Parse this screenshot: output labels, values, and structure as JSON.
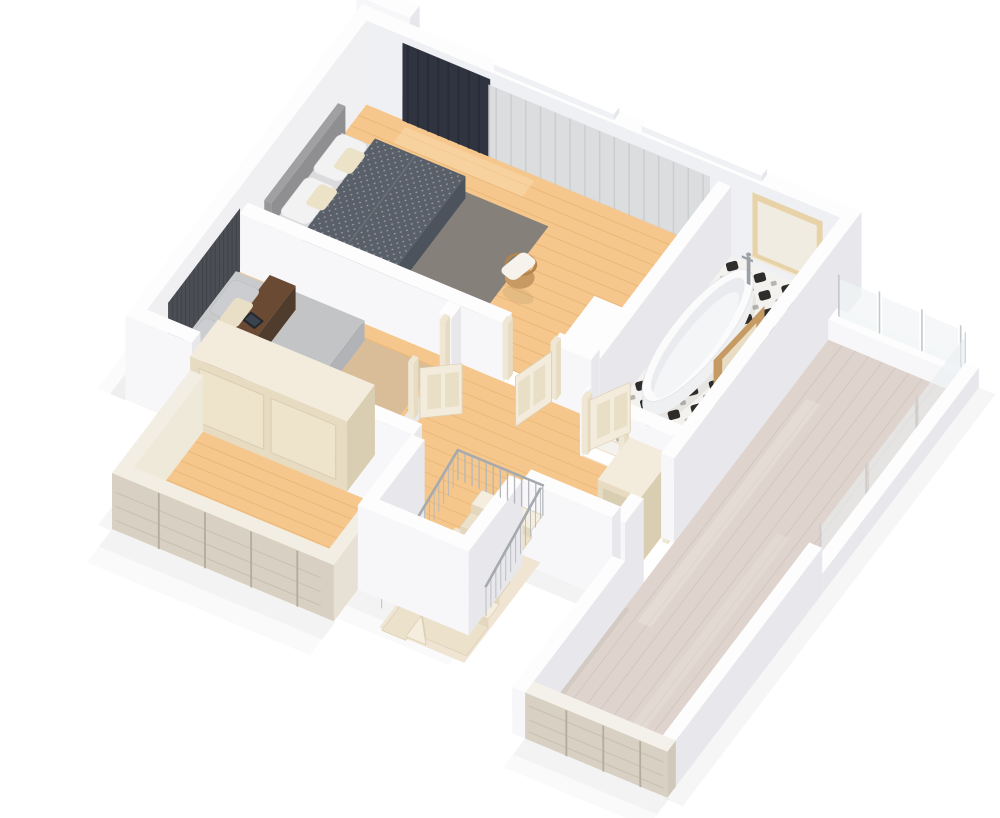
{
  "image": {
    "description": "3D isometric render of an upper-storey floor plan with two bedrooms, a bathroom, a winder staircase landing, a balcony and a large roof terrace",
    "projection": "isometric-3d-render",
    "background": "#ffffff"
  },
  "rooms": [
    {
      "id": "master-bedroom",
      "label": "Master bedroom",
      "furniture": [
        "double-bed",
        "upholstered-headboard",
        "pillows",
        "dotted-duvet",
        "dark-area-rug",
        "blackout-curtain",
        "sheer-curtain",
        "rattan-chair",
        "white-cabinet"
      ]
    },
    {
      "id": "second-bedroom",
      "label": "Second bedroom",
      "furniture": [
        "bed",
        "slat-accent-wall",
        "brown-runner",
        "tablet",
        "pillows",
        "tan-area-rug"
      ]
    },
    {
      "id": "bathroom",
      "label": "Bathroom",
      "furniture": [
        "freestanding-bathtub",
        "faucet",
        "patterned-tile-floor",
        "window",
        "vanity-mirror",
        "washbasin",
        "bottles"
      ]
    },
    {
      "id": "landing",
      "label": "Hallway landing",
      "furniture": [
        "winder-staircase",
        "stair-railing",
        "tall-wardrobe",
        "low-cabinet",
        "interior-doors"
      ]
    },
    {
      "id": "balcony",
      "label": "Balcony",
      "furniture": [
        "built-in-wardrobe",
        "timber-balustrade"
      ]
    },
    {
      "id": "terrace",
      "label": "Roof terrace",
      "furniture": [
        "whitewashed-deck",
        "glass-balustrade",
        "parapet-walls"
      ]
    }
  ],
  "palette": {
    "background": "#ffffff",
    "shadow": "#1b1b20",
    "wallTop": "#fdfdfe",
    "wallFront": "#f7f7f9",
    "wallSide": "#e8e8ec",
    "wallInner": "#eff0f3",
    "floorWood": "#f5c78c",
    "floorWoodLine": "#dfa660",
    "floorWoodLight": "#fadfb4",
    "terraceWood": "#ded4cd",
    "terraceWoodLine": "#ccc0b8",
    "terraceWoodLight": "#eae2dc",
    "balustradeWood": "#d8d0c2",
    "balustradeStreak": "#c6bdae",
    "balustradePost": "#b4ac9d",
    "tileBase": "#f4f2ef",
    "tileBlack": "#2f2d2c",
    "tileGray": "#b8b4b0",
    "cream": "#f3ebdb",
    "creamShade": "#e7dbc2",
    "creamDark": "#d9cdb2",
    "curtainDark": "#2f3440",
    "curtainDarkFold": "#252a35",
    "curtainSheer": "#d9dbdc",
    "curtainSheerFold": "#c7caca",
    "rugDark": "#85807a",
    "rugTan": "#d9bd98",
    "duvetDark": "#596069",
    "duvetDarkSide": "#4d535c",
    "mattress": "#dbdbdd",
    "bedSide": "#c6c6c9",
    "headboard": "#a0a0a3",
    "headboardSide": "#8f8f92",
    "pillowWhite": "#f2f2f3",
    "pillowCream": "#ece2c8",
    "accentWall": "#4b4e54",
    "accentSlat": "#3e4147",
    "bed2Top": "#c9cacc",
    "bed2Duvet": "#c3c4c6",
    "bed2Frame": "#2b2b2e",
    "brownWood": "#6b4a33",
    "brownWoodSide": "#513828",
    "tablet": "#24272c",
    "tabletScreen": "#3b434f",
    "rattan": "#c79a63",
    "rattanDark": "#b3854d",
    "throw": "#f6f3ec",
    "tubWhite": "#fbfbfc",
    "tubSide": "#eef0f2",
    "tubInner": "#e9ebee",
    "tubBottom": "#f4f5f7",
    "chrome": "#9aa0a6",
    "vanityWood": "#c69a63",
    "vanityWoodDark": "#b0854e",
    "mirrorInset": "#e8ddc4",
    "counterWhite": "#fafafa",
    "counterSide": "#eff0f2",
    "basinInner": "#eceef0",
    "bottleAmber": "#d99b4d",
    "bottleLight": "#e6b96b",
    "railing": "#b3b7bb",
    "railingDark": "#a6aaae",
    "stepCream": "#f5eddd",
    "stepShade": "#ece1cb",
    "stepEdge": "#dccfb4",
    "pitFloor": "#efe5d2",
    "glass": "#e9eef0",
    "glassPost": "#c6cacd",
    "windowWood": "#e8d2a8",
    "windowInner": "#f1ece2",
    "doorLeaf": "#f3ebdb",
    "doorFrame": "#efe7d4",
    "doorPanel": "#e9dec6",
    "doorEdge": "#ddd1b6"
  }
}
